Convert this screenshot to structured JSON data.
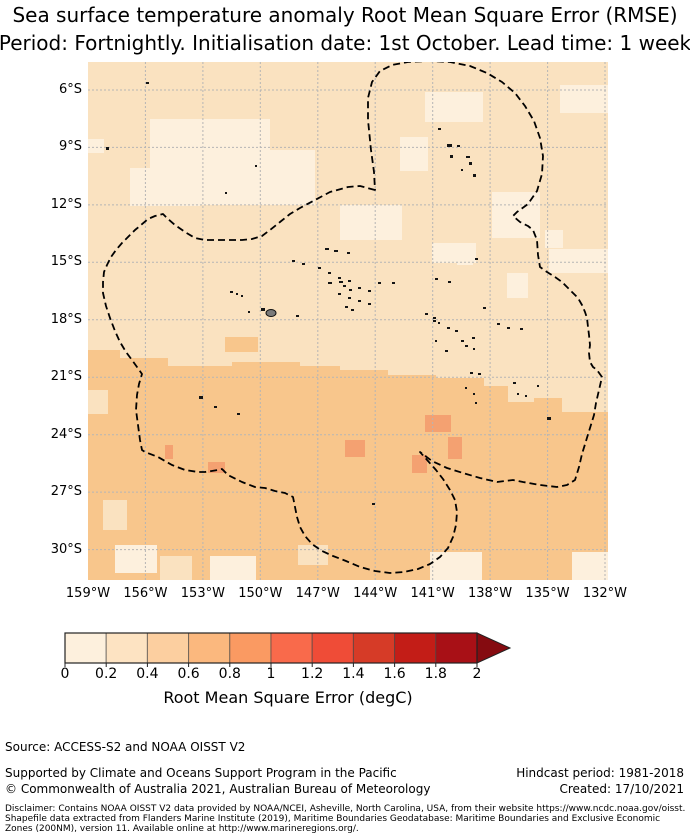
{
  "title": {
    "line1": "Sea surface temperature anomaly Root Mean Square Error (RMSE)",
    "line2": "Period: Fortnightly. Initialisation date: 1st October. Lead time: 1 week"
  },
  "map": {
    "y_ticks": [
      "6°S",
      "9°S",
      "12°S",
      "15°S",
      "18°S",
      "21°S",
      "24°S",
      "27°S",
      "30°S"
    ],
    "x_ticks": [
      "159°W",
      "156°W",
      "153°W",
      "150°W",
      "147°W",
      "144°W",
      "141°W",
      "138°W",
      "135°W",
      "132°W"
    ]
  },
  "colorbar": {
    "label": "Root Mean Square Error (degC)",
    "ticks": [
      "0",
      "0.2",
      "0.4",
      "0.6",
      "0.8",
      "1",
      "1.2",
      "1.4",
      "1.6",
      "1.8",
      "2"
    ],
    "colors": [
      "#fdf0dd",
      "#fde3c2",
      "#fccfa0",
      "#fbb87e",
      "#fa9a62",
      "#f96a4b",
      "#ef4c37",
      "#d63b27",
      "#c31d17",
      "#a81016"
    ],
    "arrow_color": "#850b10"
  },
  "footer": {
    "source": "Source: ACCESS-S2 and NOAA OISST V2",
    "supported": "Supported by Climate and Oceans Support Program in the Pacific",
    "copyright": "© Commonwealth of Australia 2021, Australian Bureau of Meteorology",
    "hindcast": "Hindcast period: 1981-2018",
    "created": "Created: 17/10/2021",
    "disclaimer_line1": "Disclaimer: Contains NOAA OISST V2 data provided by NOAA/NCEI, Asheville, North Carolina, USA, from their website https://www.ncdc.noaa.gov/oisst.",
    "disclaimer_line2": "Shapefile data extracted from Flanders Marine Institute (2019), Maritime Boundaries Geodatabase: Maritime Boundaries and Exclusive Economic",
    "disclaimer_line3": "Zones (200NM), version 11. Available online at http://www.marineregions.org/."
  },
  "chart_data": {
    "type": "heatmap",
    "title": "Sea surface temperature anomaly Root Mean Square Error (RMSE)",
    "subtitle": "Period: Fortnightly. Initialisation date: 1st October. Lead time: 1 week",
    "x": {
      "ticks": [
        "159°W",
        "156°W",
        "153°W",
        "150°W",
        "147°W",
        "144°W",
        "141°W",
        "138°W",
        "135°W",
        "132°W"
      ],
      "range_deg_west": [
        159,
        131.9
      ]
    },
    "y": {
      "ticks": [
        "6°S",
        "9°S",
        "12°S",
        "15°S",
        "18°S",
        "21°S",
        "24°S",
        "27°S",
        "30°S"
      ],
      "range_deg_south": [
        4.6,
        31.5
      ]
    },
    "colorbar": {
      "label": "Root Mean Square Error (degC)",
      "tick_values": [
        0,
        0.2,
        0.4,
        0.6,
        0.8,
        1,
        1.2,
        1.4,
        1.6,
        1.8,
        2
      ],
      "extend": "max",
      "bin_width": 0.2
    },
    "zones": [
      {
        "region": "ocean north of ~20°S",
        "rmse_degC": "0.2–0.4"
      },
      {
        "region": "scattered patches north of ~20°S",
        "rmse_degC": "0–0.2"
      },
      {
        "region": "ocean south of ~20°S",
        "rmse_degC": "0.4–0.6"
      },
      {
        "region": "small patches near 24–26°S, 141–144°W and 155°W",
        "rmse_degC": "0.6–0.8"
      }
    ],
    "overlays": [
      "French Polynesia EEZ boundary (black dashed)",
      "island landmasses (black dots; Tahiti shown grey)",
      "3° dashed graticule grid"
    ],
    "legend_position": "bottom horizontal colorbar with right-pointing extension arrow"
  },
  "style": {
    "field_pale": "#fdf0dd",
    "field_base_north": "#fae2c0",
    "field_base_south": "#f8c68c",
    "field_dark_patch": "#f4a171",
    "gridline": "#b5b5b5",
    "boundary": "#000000"
  }
}
